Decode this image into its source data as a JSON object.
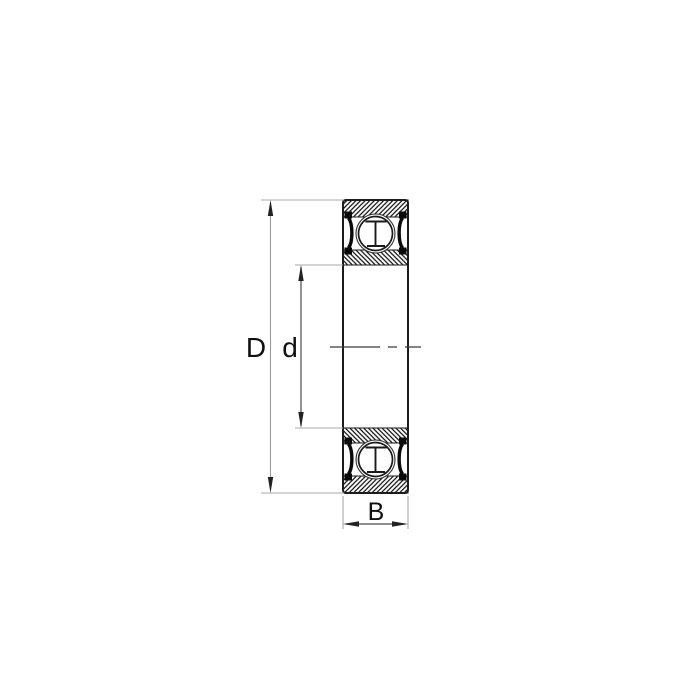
{
  "window": {
    "background": "#ffffff"
  },
  "drawing": {
    "name": "sealed-deep-groove-ball-bearing-cross-section",
    "dimensions": {
      "outer_diameter_label": "D",
      "bore_diameter_label": "d",
      "width_label": "B"
    },
    "colors": {
      "outline": "#1c1c1c",
      "hatch": "#161616",
      "seal": "#0a0a0a",
      "dimension_line_outer": "#9a9a9a",
      "dimension_line_bore": "#4a4a4a",
      "dimension_line_width": "#4a4a4a",
      "extension_line": "#a8a8a8",
      "arrowhead": "#222222",
      "label_text": "#101010",
      "centerline": "#3a3a3a",
      "background": "#ffffff"
    }
  }
}
